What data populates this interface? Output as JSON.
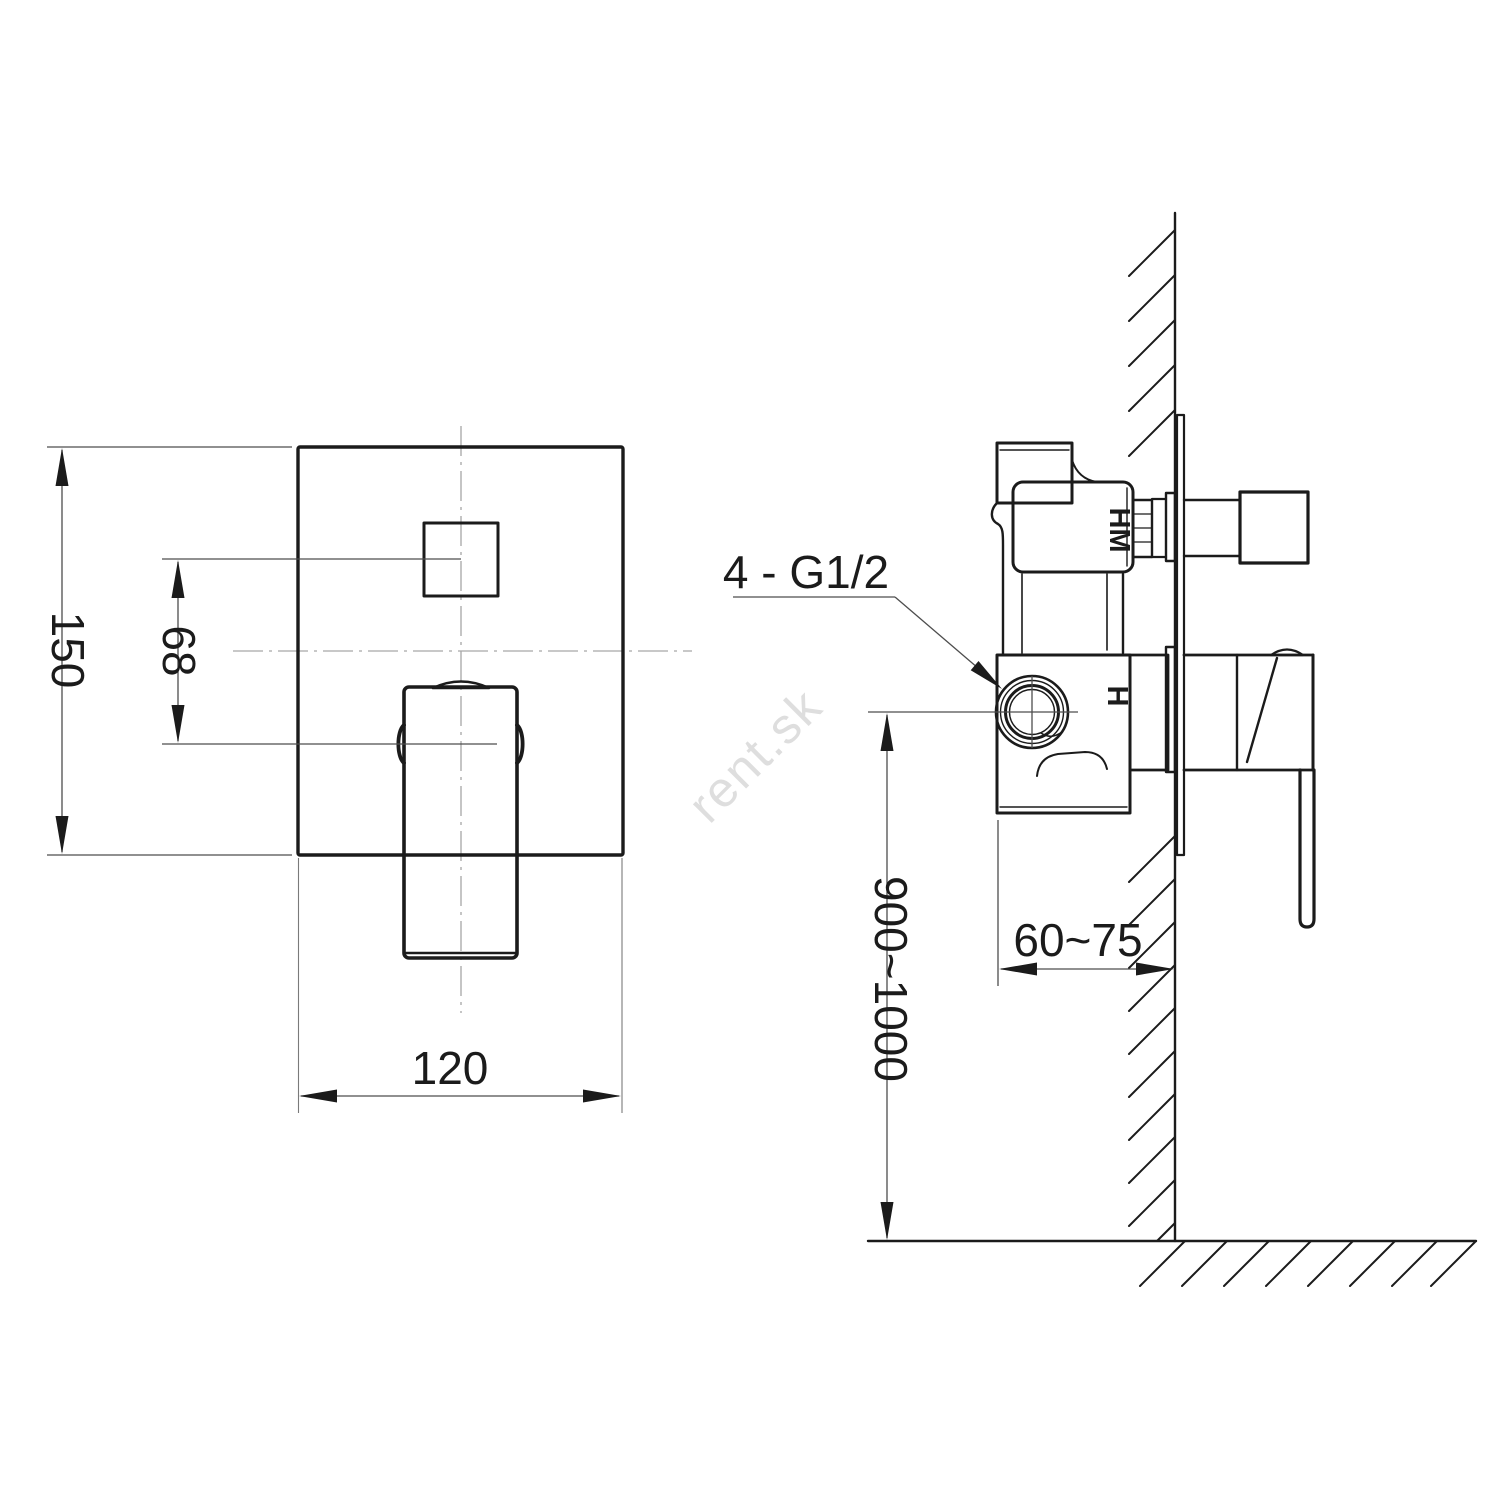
{
  "drawing": {
    "watermark": "rent.sk",
    "front_view": {
      "dim_height": "150",
      "dim_button_offset": "68",
      "dim_width": "120"
    },
    "side_view": {
      "connection_label": "4 - G1/2",
      "dim_depth": "60~75",
      "dim_mounting_height": "900~1000",
      "marking_hm": "HM",
      "marking_h": "H"
    },
    "colors": {
      "line": "#1b1b1b",
      "thin_line": "#4d4d4d",
      "centerline": "#a6a6a6",
      "watermark": "#dedede",
      "background": "#ffffff"
    }
  }
}
